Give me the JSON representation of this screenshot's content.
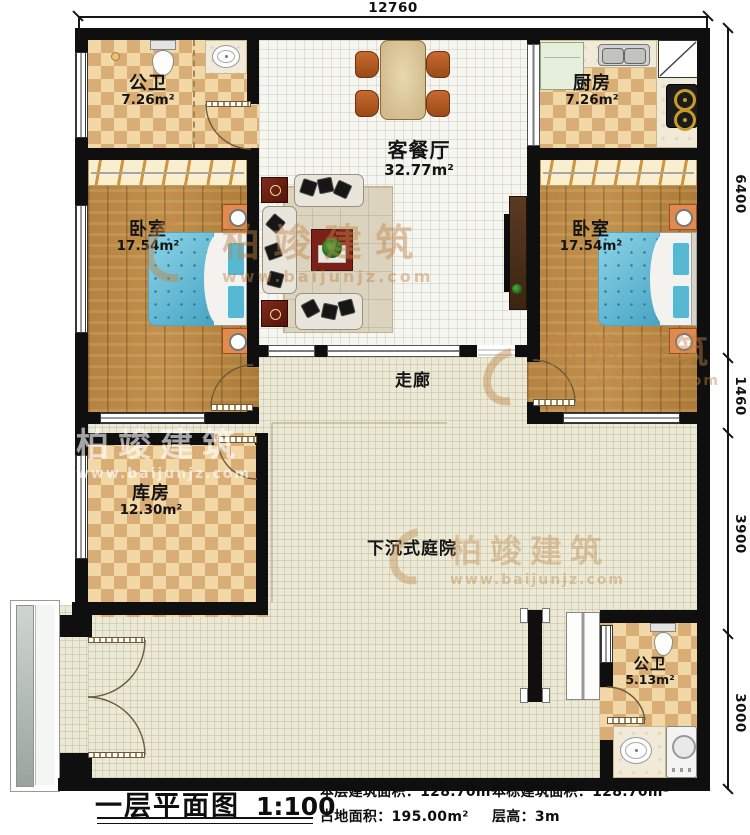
{
  "plan": {
    "dim_top": "12760",
    "dims_right": [
      "6400",
      "1460",
      "3900",
      "3000"
    ],
    "rooms": {
      "bath_top": {
        "name": "公卫",
        "area": "7.26m²"
      },
      "kitchen": {
        "name": "厨房",
        "area": "7.26m²"
      },
      "living": {
        "name": "客餐厅",
        "area": "32.77m²"
      },
      "bedroom_left": {
        "name": "卧室",
        "area": "17.54m²"
      },
      "bedroom_right": {
        "name": "卧室",
        "area": "17.54m²"
      },
      "corridor": {
        "name": "走廊"
      },
      "storage": {
        "name": "库房",
        "area": "12.30m²"
      },
      "courtyard": {
        "name": "下沉式庭院"
      },
      "bath_bottom": {
        "name": "公卫",
        "area": "5.13m²"
      }
    }
  },
  "watermark": {
    "brand": "柏竣建筑",
    "url": "www.baijunjz.com"
  },
  "footer": {
    "title": "一层平面图",
    "scale": "1:100",
    "stats": [
      {
        "label": "本层建筑面积：",
        "value": "128.70m²"
      },
      {
        "label": "本栋建筑面积：",
        "value": "128.70m²"
      },
      {
        "label": "占地面积：",
        "value": "195.00m²"
      },
      {
        "label": "层高：",
        "value": "3m"
      }
    ]
  },
  "colors": {
    "wall": "#0f0f0f",
    "tile_light": "#f2d8a6",
    "tile_dark": "#d9ad76",
    "wood": "#b5833f",
    "bed_blue": "#7cc5db",
    "floor_beige": "#ecead6",
    "accent_orange": "#e08a4e",
    "watermark_tan": "#c1854a"
  }
}
